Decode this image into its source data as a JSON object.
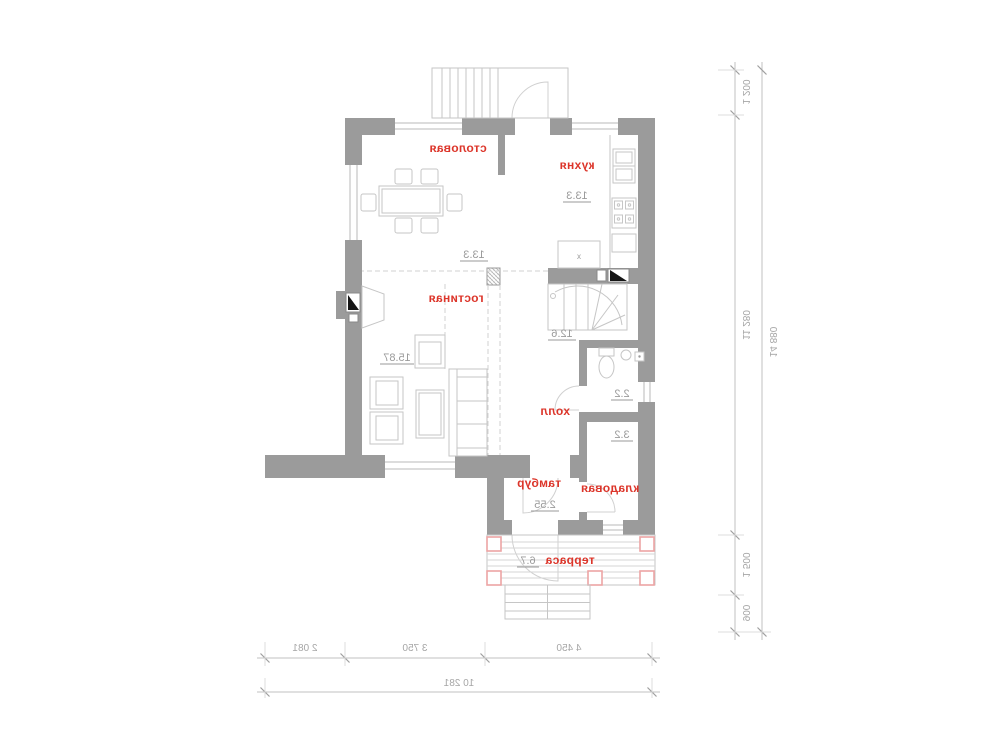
{
  "plan_title": "first-floor-plan",
  "rooms": {
    "dining": {
      "label": "столовая",
      "area": "13.3"
    },
    "kitchen": {
      "label": "кухня",
      "area": "13.3"
    },
    "living": {
      "label": "гостиная",
      "area": "15.87"
    },
    "hall": {
      "label": "холл",
      "area": "12.6"
    },
    "wc": {
      "area": "2.2"
    },
    "storage": {
      "label": "кладовая",
      "area": "3.2"
    },
    "vestibule": {
      "label": "тамбур",
      "area": "2.55"
    },
    "terrace": {
      "label": "терраса",
      "area": "6.7"
    }
  },
  "kitchen_island_mark": "x",
  "dims": {
    "v1": "1 200",
    "v2": "11 280",
    "v3": "1 500",
    "v4": "900",
    "v_total": "14 880",
    "h1": "2 081",
    "h2": "3 750",
    "h3": "4 450",
    "h_total": "10 281"
  },
  "colors": {
    "wall": "#9b9b9b",
    "room_label": "#dc352a",
    "area_label": "#9a9a9a",
    "terrace_post": "#eda4a4",
    "thin_line": "#c6c6c6",
    "dim_text": "#a6a6a6"
  }
}
